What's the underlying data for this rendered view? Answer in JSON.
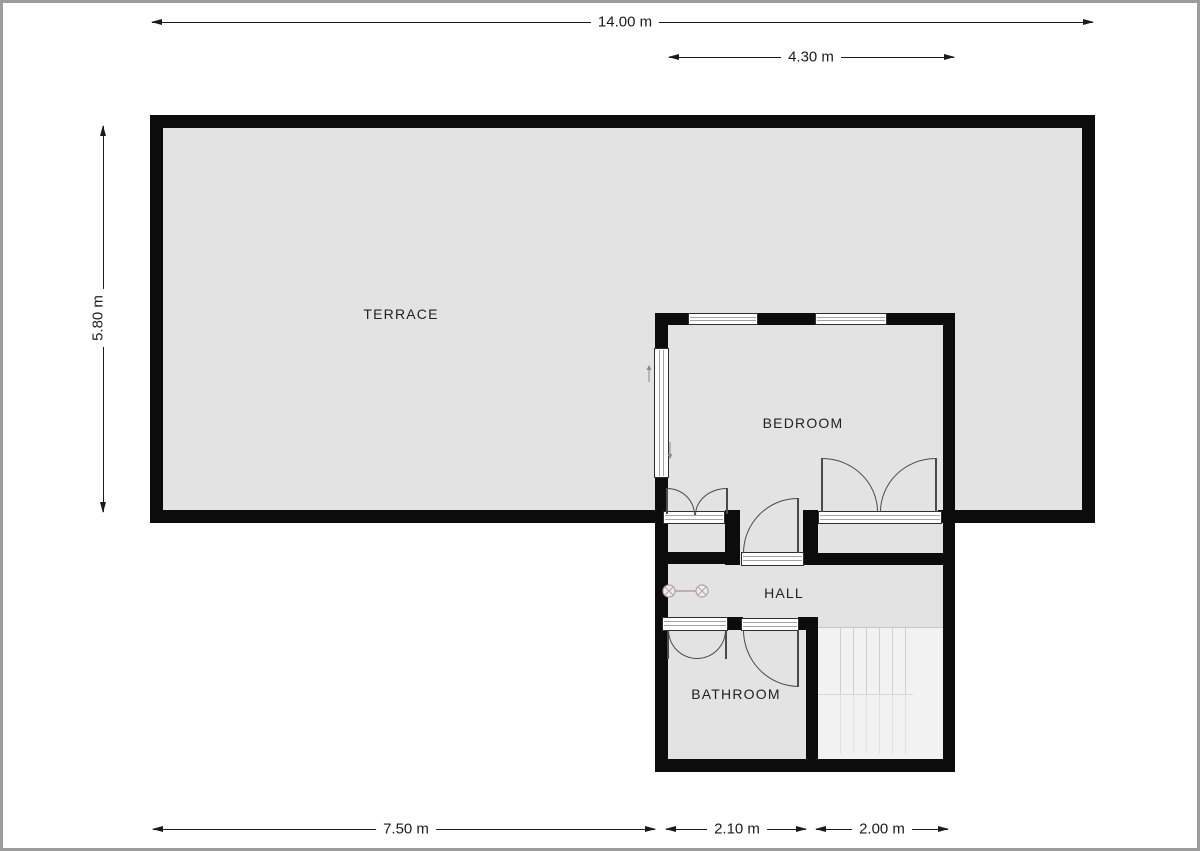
{
  "rooms": {
    "terrace": {
      "label": "TERRACE"
    },
    "bedroom": {
      "label": "BEDROOM"
    },
    "hall": {
      "label": "HALL"
    },
    "bathroom": {
      "label": "BATHROOM"
    }
  },
  "dims": {
    "overall_width": {
      "label": "14.00 m"
    },
    "bedroom_width": {
      "label": "4.30 m"
    },
    "overall_depth": {
      "label": "5.80 m"
    },
    "terrace_width": {
      "label": "7.50 m"
    },
    "hall_width": {
      "label": "2.10 m"
    },
    "stairs_width": {
      "label": "2.00 m"
    }
  },
  "colors": {
    "wall": "#0c0c0c",
    "room": "#e3e3e3",
    "stairs": "#f2f2f2",
    "door": "#4a4a4a",
    "dim": "#1b1b1b",
    "frame": "#9c9c9c",
    "window_border": "#2e2e2e",
    "label": "#222222"
  }
}
